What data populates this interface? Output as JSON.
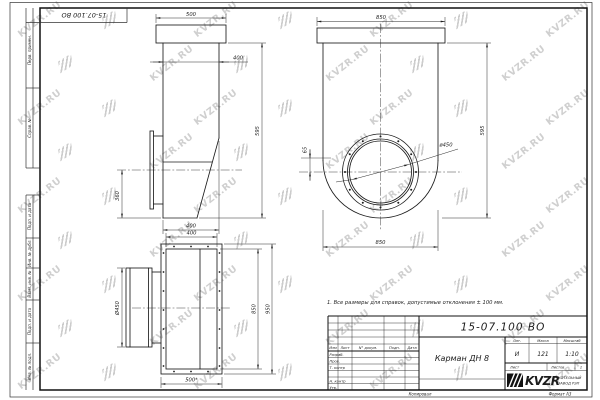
{
  "watermark": {
    "text": "KVZR.RU"
  },
  "corner_stamp": {
    "doc_number": "15-07.100 ВО"
  },
  "margin_labels": {
    "perv": "Перв. примен.",
    "sprav": "Справ. №",
    "podp1": "Подп. и дата",
    "inv_dubl": "Инв. № дубл.",
    "vzam": "Взам. инв. №",
    "podp2": "Подп. и дата",
    "inv_podl": "Инв. № подл."
  },
  "views": {
    "note": "1. Все размеры для справок, допустимые отклонения ± 100 мм.",
    "front": {
      "dim_top": "500",
      "dim_width": "400",
      "dim_height": "595",
      "dim_left": "360",
      "dim_bottom": "400"
    },
    "plan": {
      "dim_top": "400",
      "dim_left": "Ø450",
      "dim_right_inner": "850",
      "dim_right_outer": "950",
      "dim_bottom": "500*"
    },
    "side": {
      "dim_top": "850",
      "dim_right": "595",
      "dim_bottom": "850",
      "dim_offset": "65",
      "dim_diameter": "ø450"
    }
  },
  "title_block": {
    "doc_number": "15-07.100 ВО",
    "part_name": "Карман ДН 8",
    "header_cols": {
      "izm": "Изм",
      "list": "Лист",
      "doc": "N° докум.",
      "podp": "Подп.",
      "data": "Дата"
    },
    "rows": {
      "razrab": "Разраб.",
      "prov": "Пров.",
      "t_contr": "Т. контр",
      "n_contr": "Н. контр",
      "utv": "Утв."
    },
    "lit_label": "Лит.",
    "mass_label": "Масса",
    "scale_label": "Масштаб",
    "lit": "И",
    "mass": "121",
    "scale": "1:10",
    "sheet_label": "Лист",
    "sheets_label": "Листов",
    "sheets_value": "1",
    "logo_text": "KVZR",
    "logo_sub1": "КОТЕЛЬНЫЙ",
    "logo_sub2": "ЗАВОД РЭП"
  },
  "footer": {
    "copied": "Копировал",
    "format": "Формат А3"
  }
}
